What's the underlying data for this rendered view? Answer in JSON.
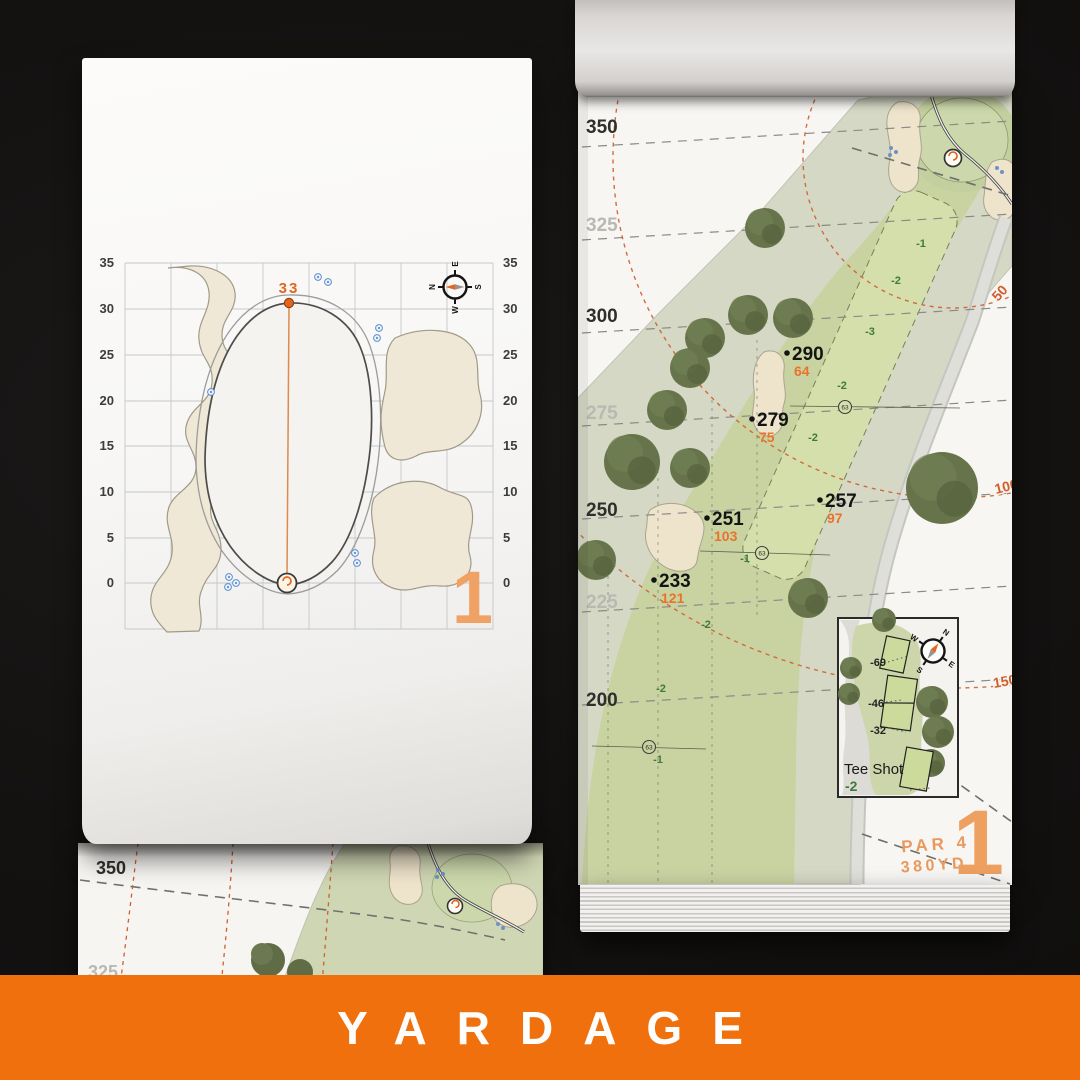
{
  "banner": {
    "label": "YARDAGE"
  },
  "compass": {
    "n": "N",
    "e": "E",
    "s": "S",
    "w": "W"
  },
  "left_page": {
    "hole_number": "1",
    "pin_distance": "33",
    "axis": [
      "35",
      "30",
      "25",
      "20",
      "15",
      "10",
      "5",
      "0"
    ]
  },
  "right_page": {
    "hole_number": "1",
    "par": "PAR 4",
    "yardage": "380YD",
    "yardlines": [
      {
        "label": "350"
      },
      {
        "label": "325"
      },
      {
        "label": "300"
      },
      {
        "label": "275"
      },
      {
        "label": "250"
      },
      {
        "label": "225"
      },
      {
        "label": "200"
      }
    ],
    "arc_labels": [
      "50",
      "100",
      "150"
    ],
    "markers": [
      {
        "yards": "290",
        "to_pin": "64"
      },
      {
        "yards": "279",
        "to_pin": "75"
      },
      {
        "yards": "257",
        "to_pin": "97"
      },
      {
        "yards": "251",
        "to_pin": "103"
      },
      {
        "yards": "233",
        "to_pin": "121"
      }
    ],
    "slopes": [
      "-1",
      "-2",
      "-3",
      "-2",
      "-2",
      "-1",
      "-2",
      "-2",
      "-1"
    ],
    "sprinkler_heads": [
      "63",
      "63",
      "63"
    ],
    "tee_inset": {
      "title": "Tee Shot",
      "slope": "-2",
      "carries": [
        "-69",
        "-46",
        "-32"
      ]
    }
  },
  "under_page": {
    "yardlines": [
      "350",
      "325"
    ]
  },
  "colors": {
    "banner_orange": "#f1700e",
    "accent_orange": "#e2661f",
    "distance_orange": "#e8732a",
    "arc_orange": "#cf5f2e",
    "hole_number_orange": "#efa263",
    "fairway_green": "#c9d3a2",
    "rough_green": "#d5d8c5",
    "strip_green": "#d6e0ac",
    "tree_green": "#67744b",
    "bunker_sand": "#eee3cb",
    "slope_green": "#3e7a3e",
    "sprinkler_blue": "#5b8fd0"
  }
}
